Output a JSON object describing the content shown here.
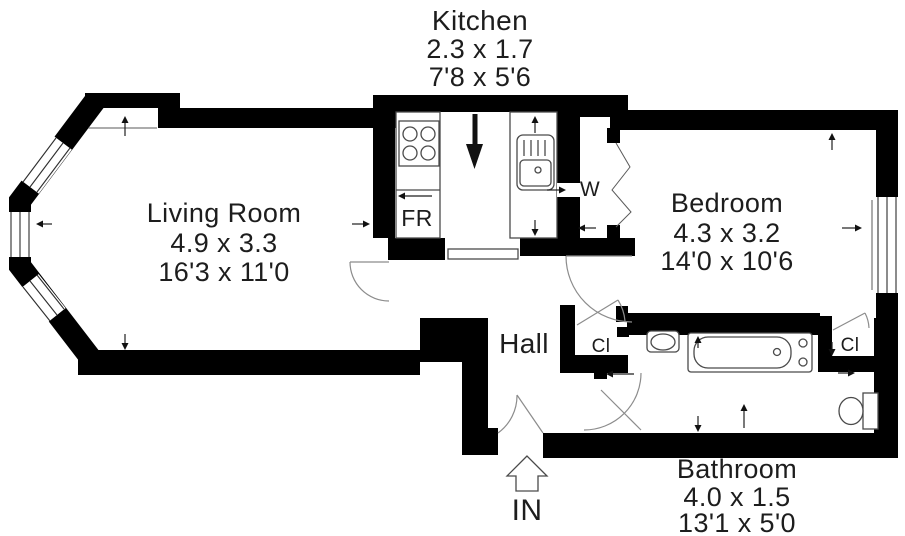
{
  "rooms": {
    "kitchen": {
      "name": "Kitchen",
      "dim_metric": "2.3 x 1.7",
      "dim_imperial": "7'8 x 5'6"
    },
    "living_room": {
      "name": "Living Room",
      "dim_metric": "4.9 x 3.3",
      "dim_imperial": "16'3 x 11'0"
    },
    "bedroom": {
      "name": "Bedroom",
      "dim_metric": "4.3 x 3.2",
      "dim_imperial": "14'0 x 10'6"
    },
    "hall": {
      "name": "Hall"
    },
    "bathroom": {
      "name": "Bathroom",
      "dim_metric": "4.0 x 1.5",
      "dim_imperial": "13'1 x 5'0"
    }
  },
  "markers": {
    "fridge": "FR",
    "wardrobe": "W",
    "hall_closet": "Cl",
    "bedroom_closet": "Cl",
    "entrance": "IN"
  },
  "colors": {
    "wall": "#000000",
    "background": "#ffffff",
    "text": "#1d1d1d"
  }
}
